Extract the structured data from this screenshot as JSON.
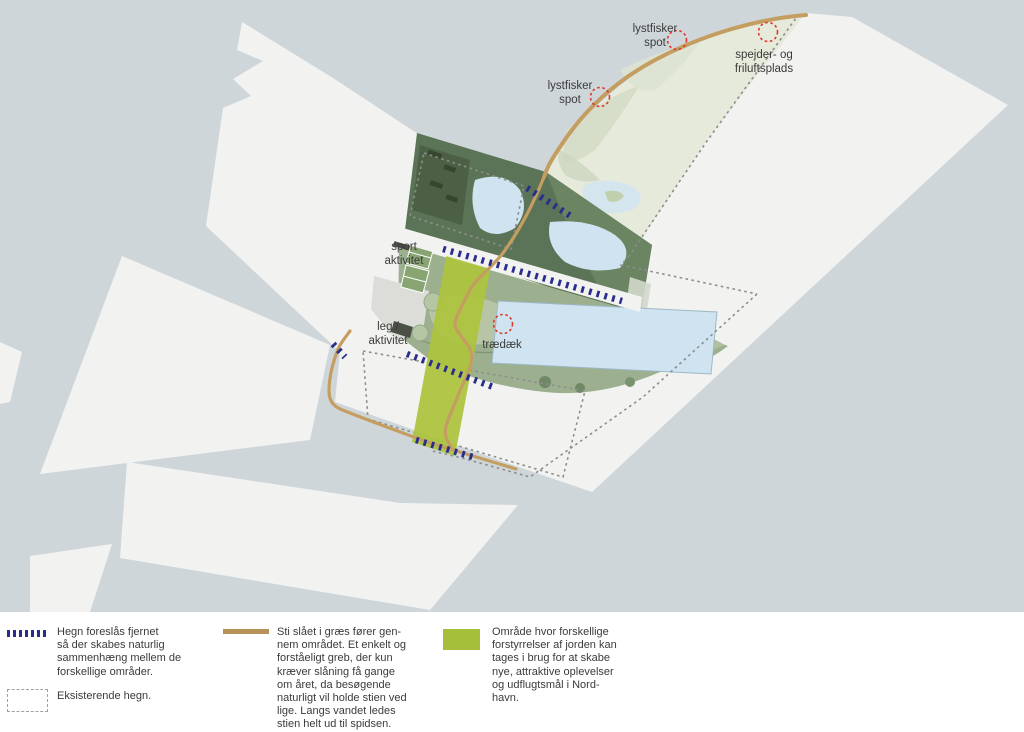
{
  "map": {
    "labels": [
      {
        "id": "lystfisker-spot-1",
        "text": "lystfisker\nspot"
      },
      {
        "id": "spejder-friluftsplads",
        "text": "spejder- og\nfriluftsplads"
      },
      {
        "id": "lystfisker-spot-2",
        "text": "lystfisker\nspot"
      },
      {
        "id": "sport-aktivitet",
        "text": "sport\naktivitet"
      },
      {
        "id": "leg-aktivitet",
        "text": "leg /\naktivitet"
      },
      {
        "id": "traedaek",
        "text": "trædæk"
      }
    ],
    "markers": [
      {
        "type": "red-dotted-circle",
        "at_label": "lystfisker spot (top)"
      },
      {
        "type": "red-dotted-circle",
        "at_label": "spejder- og friluftsplads"
      },
      {
        "type": "red-dotted-circle",
        "at_label": "lystfisker spot (left)"
      },
      {
        "type": "red-dotted-circle",
        "at_label": "trædæk"
      }
    ]
  },
  "legend": {
    "items": [
      {
        "swatch": "blue-dashes",
        "text": "Hegn foreslås fjernet\nså der skabes naturlig\nsammenhæng mellem de\nforskellige områder."
      },
      {
        "swatch": "dashed-rect",
        "text": "Eksisterende hegn."
      },
      {
        "swatch": "tan-line",
        "text": "Sti slået i græs fører gen-\nnem området. Et enkelt og\nforståeligt greb, der kun\nkræver slåning få gange\nom året, da besøgende\nnaturligt vil holde stien ved\nlige. Langs vandet ledes\nstien helt ud til spidsen."
      },
      {
        "swatch": "green-area",
        "text": "Område hvor forskellige\nforstyrrelser af jorden kan\ntages i brug for at skabe\nnye, attraktive oplevelser\nog udflugtsmål i Nord-\nhavn."
      }
    ]
  },
  "colors": {
    "water": "#cfd6da",
    "land": "#f2f3f1",
    "path_tan": "#c49d61",
    "legend_path_tan": "#b69158",
    "fence_removed_blue": "#2a2d8c",
    "existing_fence_gray": "#8d8d8d",
    "disturbance_green": "#a6bf3a",
    "dark_vegetation": "#5b7356",
    "mid_vegetation": "#9cb08f",
    "pale_vegetation": "#e6eadb",
    "lake_blue": "#cfe4f0",
    "red_marker": "#e03a2d",
    "text": "#3b3b3b"
  }
}
